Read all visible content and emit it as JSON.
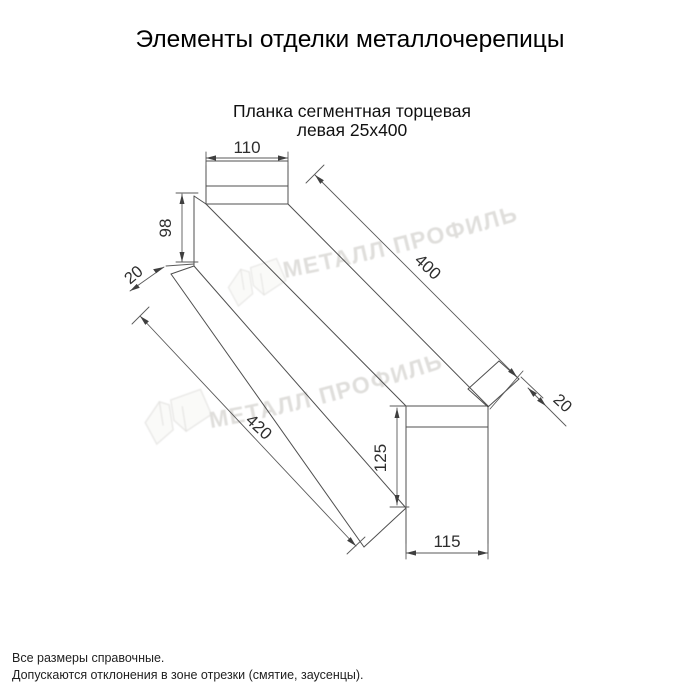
{
  "page": {
    "title": "Элементы отделки металлочерепицы",
    "subtitle_line1": "Планка сегментная торцевая",
    "subtitle_line2": "левая 25х400"
  },
  "drawing": {
    "dims": {
      "top_width": "110",
      "left_height": "98",
      "left_flange": "20",
      "length_top": "400",
      "length_bottom": "420",
      "right_flange": "20",
      "right_height": "125",
      "bottom_width": "115"
    }
  },
  "watermark": {
    "text": "МЕТАЛЛ ПРОФИЛЬ",
    "color": "#c6c4bf"
  },
  "footer": {
    "line1": "Все размеры справочные.",
    "line2": "Допускаются отклонения в зоне отрезки (смятие, заусенцы)."
  },
  "colors": {
    "background": "#ffffff",
    "drawing_line": "#4f4f4f",
    "dimension_text": "#2e2e2e",
    "title_text": "#000000"
  }
}
